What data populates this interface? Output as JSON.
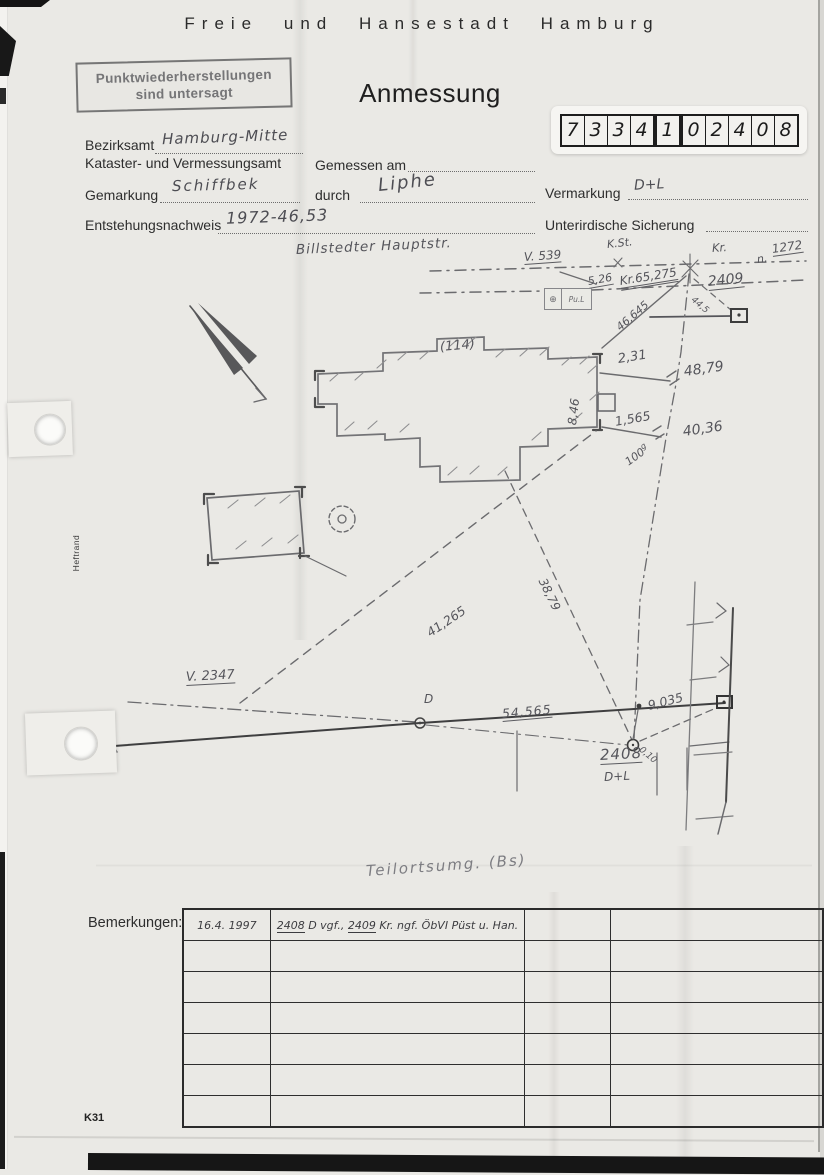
{
  "page": {
    "header": "Freie und Hansestadt Hamburg",
    "title": "Anmessung",
    "stamp": {
      "line1": "Punktwiederherstellungen",
      "line2": "sind untersagt"
    },
    "code_digits": [
      "7",
      "3",
      "3",
      "4",
      "1",
      "0",
      "2",
      "4",
      "0",
      "8"
    ],
    "heftrand": "Heftrand",
    "form_code": "K31"
  },
  "form": {
    "bezirksamt": {
      "label": "Bezirksamt",
      "value": "Hamburg-Mitte"
    },
    "amt_line": "Kataster- und Vermessungsamt",
    "gemessen_am": {
      "label": "Gemessen am",
      "value": ""
    },
    "gemarkung": {
      "label": "Gemarkung",
      "value": "Schiffbek"
    },
    "durch": {
      "label": "durch",
      "value": "Liphe"
    },
    "vermarkung": {
      "label": "Vermarkung",
      "value": "D+L"
    },
    "entstehungsnachweis": {
      "label": "Entstehungsnachweis",
      "value": "1972-46,53"
    },
    "sicherung": {
      "label": "Unterirdische Sicherung",
      "value": ""
    }
  },
  "sketch": {
    "street_name": "Billstedter Hauptstr.",
    "caption": "Teilortsumg. (Bs)",
    "point_box": {
      "symbol": "⊕",
      "text": "Pu.L"
    },
    "labels": {
      "v539": "V. 539",
      "kst": "K.St.",
      "kr": "Kr.",
      "n_prefix": "n.",
      "n_value": "1272",
      "m526": "5,26",
      "kr65275": "Kr.65,275",
      "p2409": "2409",
      "m46645": "46,645",
      "m445": "44,5",
      "house": "(114)",
      "m231": "2,31",
      "m4879": "48,79",
      "m846": "8,46",
      "m1565": "1,565",
      "m4036": "40,36",
      "g100": "100",
      "g100sup": "g",
      "v2347": "V. 2347",
      "m3879": "38,79",
      "m41265": "41,265",
      "pd": "D",
      "m54565": "54,565",
      "m9035": "9,035",
      "p2408": "2408",
      "dl": "D+L",
      "m010": "0,10"
    }
  },
  "remarks": {
    "label": "Bemerkungen:",
    "row1": {
      "date": "16.4. 1997",
      "num1": "2408",
      "mid": " D vgf., ",
      "num2": "2409",
      "rest": " Kr. ngf. ÖbVI Püst u. Han."
    }
  }
}
